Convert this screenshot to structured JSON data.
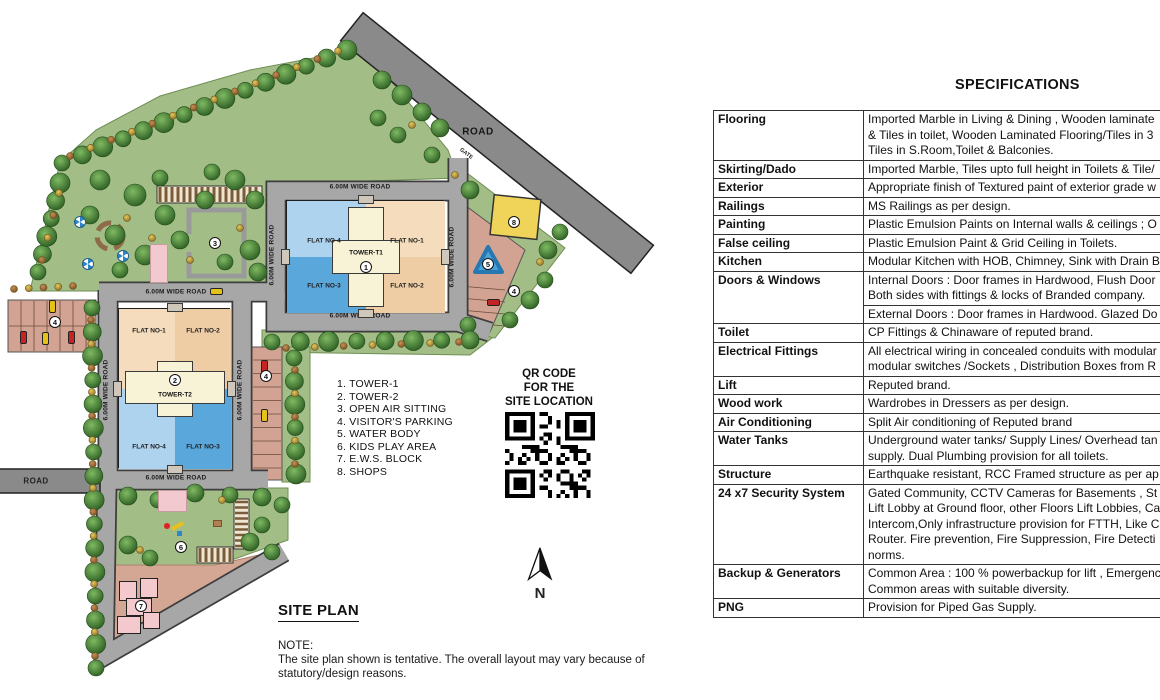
{
  "site_plan": {
    "heading": "SITE PLAN",
    "note": {
      "label": "NOTE:",
      "lines": [
        "The site plan shown is tentative. The overall layout may vary because of",
        "statutory/design reasons."
      ]
    },
    "legend": [
      "1. TOWER-1",
      "2. TOWER-2",
      "3. OPEN AIR SITTING",
      "4. VISITOR'S PARKING",
      "5. WATER BODY",
      "6. KIDS PLAY AREA",
      "7. E.W.S. BLOCK",
      "8. SHOPS"
    ],
    "qr_caption": [
      "QR CODE",
      "FOR THE",
      "SITE LOCATION"
    ],
    "north_label": "N",
    "labels": {
      "wide_road": "6.00M WIDE ROAD",
      "road": "ROAD",
      "gate": "GATE"
    },
    "towers": {
      "t1": {
        "name": "TOWER-T1",
        "number": "1",
        "flats": [
          "FLAT NO-4",
          "FLAT NO-1",
          "FLAT NO-3",
          "FLAT NO-2"
        ]
      },
      "t2": {
        "name": "TOWER-T2",
        "number": "2",
        "flats": [
          "FLAT NO-1",
          "FLAT NO-2",
          "FLAT NO-4",
          "FLAT NO-3"
        ]
      }
    },
    "badges": [
      {
        "n": "3",
        "x": 215,
        "y": 243
      },
      {
        "n": "4",
        "x": 55,
        "y": 322
      },
      {
        "n": "4",
        "x": 266,
        "y": 376
      },
      {
        "n": "4",
        "x": 514,
        "y": 291
      },
      {
        "n": "5",
        "x": 488,
        "y": 264
      },
      {
        "n": "6",
        "x": 181,
        "y": 547
      },
      {
        "n": "7",
        "x": 141,
        "y": 606
      },
      {
        "n": "8",
        "x": 514,
        "y": 222
      }
    ]
  },
  "specifications": {
    "heading": "SPECIFICATIONS",
    "rows": [
      {
        "label": "Flooring",
        "blocks": [
          [
            "Imported Marble in Living & Dining ,  Wooden laminate",
            "& Tiles in toilet, Wooden Laminated Flooring/Tiles in 3",
            "Tiles in S.Room,Toilet & Balconies."
          ]
        ]
      },
      {
        "label": "Skirting/Dado",
        "blocks": [
          [
            "Imported Marble, Tiles upto full height in Toilets & Tile/"
          ]
        ]
      },
      {
        "label": "Exterior",
        "blocks": [
          [
            "Appropriate finish of Textured paint of exterior grade w"
          ]
        ]
      },
      {
        "label": "Railings",
        "blocks": [
          [
            "MS Railings as per design."
          ]
        ]
      },
      {
        "label": "Painting",
        "blocks": [
          [
            "Plastic Emulsion Paints on Internal walls & ceilings ; O"
          ]
        ]
      },
      {
        "label": "False ceiling",
        "blocks": [
          [
            "Plastic Emulsion Paint & Grid Ceiling in Toilets."
          ]
        ]
      },
      {
        "label": "Kitchen",
        "blocks": [
          [
            "Modular Kitchen with HOB, Chimney, Sink with Drain B"
          ]
        ]
      },
      {
        "label": "Doors & Windows",
        "blocks": [
          [
            "Internal Doors : Door  frames in Hardwood, Flush Door",
            "Both sides with fittings & locks of Branded company."
          ],
          [
            "External Doors : Door frames in Hardwood. Glazed Do"
          ]
        ]
      },
      {
        "label": "Toilet",
        "blocks": [
          [
            "CP Fittings & Chinaware of reputed brand."
          ]
        ]
      },
      {
        "label": "Electrical Fittings",
        "blocks": [
          [
            "All electrical wiring in concealed conduits with modular",
            "modular switches /Sockets , Distribution Boxes from R"
          ]
        ]
      },
      {
        "label": "Lift",
        "blocks": [
          [
            "Reputed brand."
          ]
        ]
      },
      {
        "label": "Wood work",
        "blocks": [
          [
            "Wardrobes in Dressers as per design."
          ]
        ]
      },
      {
        "label": "Air Conditioning",
        "blocks": [
          [
            "Split Air conditioning of Reputed brand"
          ]
        ]
      },
      {
        "label": "Water Tanks",
        "blocks": [
          [
            "Underground water tanks/ Supply Lines/ Overhead tan",
            "supply. Dual Plumbing provision for all toilets."
          ]
        ]
      },
      {
        "label": "Structure",
        "blocks": [
          [
            "Earthquake resistant, RCC Framed structure as per ap"
          ]
        ]
      },
      {
        "label": "24 x7 Security System",
        "blocks": [
          [
            "Gated Community, CCTV Cameras for Basements , St",
            "Lift Lobby at Ground floor, other Floors Lift Lobbies, Ca",
            "Intercom,Only infrastructure provision for FTTH, Like C",
            "Router. Fire prevention, Fire Suppression, Fire Detecti",
            "norms."
          ]
        ]
      },
      {
        "label": "Backup & Generators",
        "blocks": [
          [
            "Common Area : 100 % powerbackup for lift , Emergenc",
            "Common areas with suitable diversity."
          ]
        ]
      },
      {
        "label": "PNG",
        "blocks": [
          [
            "Provision for Piped Gas Supply."
          ]
        ]
      }
    ]
  },
  "colors": {
    "lawn": "#a2bd85",
    "road_fill": "#a7a7a7",
    "road_casing": "#3d3d3d",
    "outer_road": "#8a8a8a",
    "parking": "#d2a392",
    "water": "#4aa2da",
    "shops": "#f0d359",
    "pink": "#f2c9ce",
    "tan_light": "#f5dcbc",
    "tan_dark": "#efcda4",
    "blue_light": "#aed3ee",
    "blue_dark": "#5aa7dc",
    "core_cream": "#f8f3d6",
    "tree_dark": "#2d632c",
    "tree_light": "#6fae5a"
  }
}
